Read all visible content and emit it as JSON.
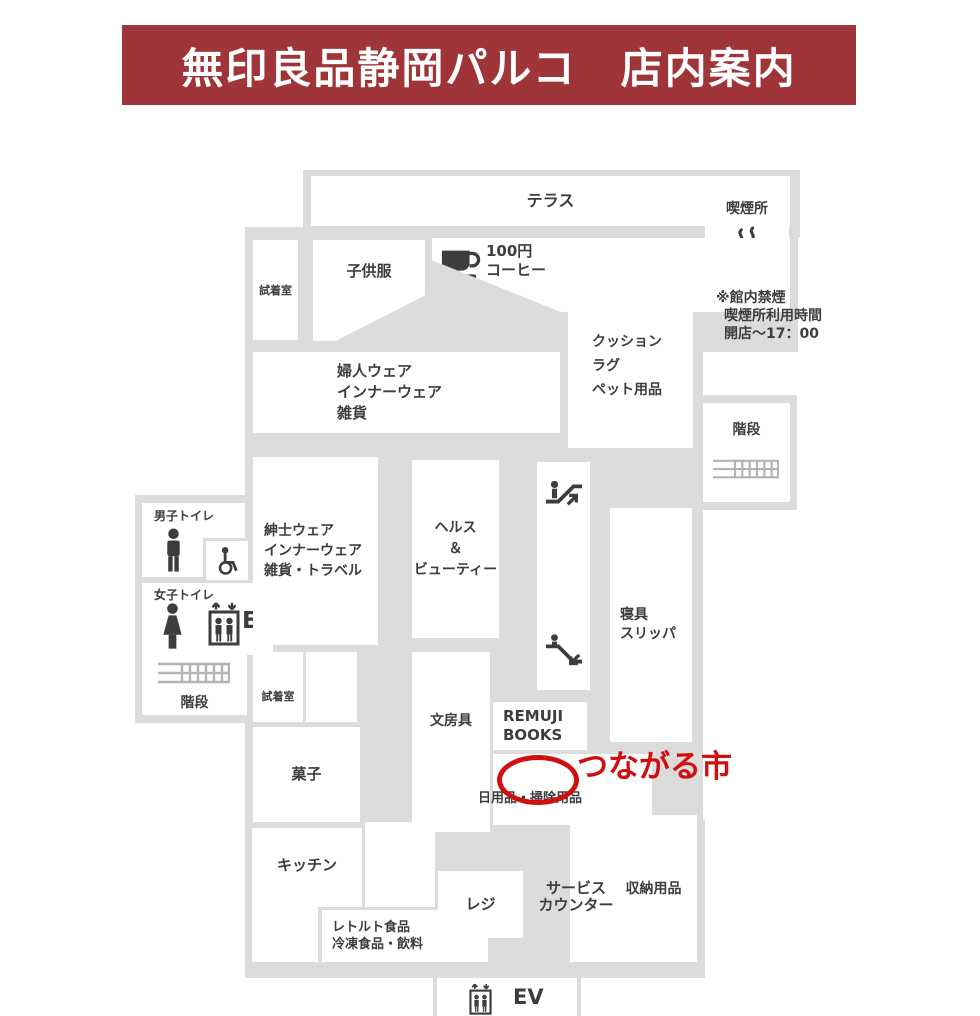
{
  "page": {
    "width": 980,
    "height": 1016,
    "bg": "#ffffff"
  },
  "palette": {
    "header_bg": "#9f3538",
    "header_fg": "#ffffff",
    "floor": "#dcdcdc",
    "room": "#ffffff",
    "ink": "#3d3d3d",
    "stairs_line": "#b3b3b3",
    "red": "#d01010"
  },
  "header": {
    "title": "無印良品静岡パルコ　店内案内"
  },
  "map": {
    "slabs": [
      {
        "x": 303,
        "y": 170,
        "w": 497,
        "h": 67
      },
      {
        "x": 697,
        "y": 172,
        "w": 100,
        "h": 116
      },
      {
        "x": 245,
        "y": 227,
        "w": 320,
        "h": 215
      },
      {
        "x": 425,
        "y": 235,
        "w": 373,
        "h": 117
      },
      {
        "x": 560,
        "y": 312,
        "w": 143,
        "h": 200
      },
      {
        "x": 695,
        "y": 395,
        "w": 102,
        "h": 115
      },
      {
        "x": 245,
        "y": 433,
        "w": 350,
        "h": 300
      },
      {
        "x": 135,
        "y": 495,
        "w": 112,
        "h": 228
      },
      {
        "x": 245,
        "y": 727,
        "w": 126,
        "h": 240
      },
      {
        "x": 360,
        "y": 727,
        "w": 60,
        "h": 100
      },
      {
        "x": 408,
        "y": 645,
        "w": 245,
        "h": 185
      },
      {
        "x": 593,
        "y": 505,
        "w": 110,
        "h": 240
      },
      {
        "x": 593,
        "y": 742,
        "w": 110,
        "h": 100
      },
      {
        "x": 245,
        "y": 820,
        "w": 460,
        "h": 158
      },
      {
        "x": 433,
        "y": 972,
        "w": 148,
        "h": 44
      }
    ],
    "rooms": [
      {
        "id": "terrace",
        "x": 311,
        "y": 176,
        "w": 479,
        "h": 50,
        "label": {
          "lines": [
            "テラス"
          ],
          "size": 16,
          "align": "center",
          "valign": "center"
        }
      },
      {
        "id": "smoking-area",
        "x": 705,
        "y": 180,
        "w": 84,
        "h": 100,
        "label": {
          "lines": [
            "喫煙所"
          ],
          "size": 14,
          "align": "center",
          "valign": "top",
          "padTop": 20
        },
        "icons": [
          {
            "type": "cigarette",
            "x": 24,
            "y": 46,
            "w": 38,
            "h": 40
          }
        ]
      },
      {
        "id": "fitting-room-upper",
        "x": 253,
        "y": 240,
        "w": 45,
        "h": 100,
        "label": {
          "lines": [
            "試着室"
          ],
          "size": 11,
          "align": "center",
          "valign": "center"
        }
      },
      {
        "id": "kids-wear",
        "x": 313,
        "y": 240,
        "w": 112,
        "h": 101,
        "clip": "polygon(0 0,100% 0,100% 55%,20% 100%,0 100%)",
        "label": {
          "lines": [
            "子供服"
          ],
          "size": 15,
          "align": "center",
          "valign": "top",
          "padTop": 22
        }
      },
      {
        "id": "coffee-corner",
        "x": 432,
        "y": 238,
        "w": 358,
        "h": 74,
        "clip": "polygon(0 0,100% 0,100% 100%,36% 100%,0 30%)",
        "label": {
          "lines": [
            "100円",
            "コーヒー"
          ],
          "size": 15,
          "lh": 19,
          "align": "left",
          "valign": "top",
          "padTop": 4,
          "padLeft": 54
        },
        "icons": [
          {
            "type": "coffee",
            "x": 7,
            "y": 5,
            "w": 42,
            "h": 40
          }
        ]
      },
      {
        "id": "womens-wear",
        "x": 253,
        "y": 352,
        "w": 307,
        "h": 81,
        "label": {
          "lines": [
            "婦人ウェア",
            "インナーウェア",
            "雑貨"
          ],
          "size": 15,
          "lh": 21,
          "align": "left",
          "valign": "center",
          "padLeft": 84
        }
      },
      {
        "id": "cushion-rug-pet",
        "x": 568,
        "y": 283,
        "w": 125,
        "h": 165,
        "label": {
          "lines": [
            "クッション",
            "ラグ",
            "ペット用品"
          ],
          "size": 14,
          "lh": 24,
          "align": "left",
          "valign": "center",
          "padLeft": 24
        }
      },
      {
        "id": "stairs-upper",
        "x": 703,
        "y": 403,
        "w": 87,
        "h": 99,
        "label": {
          "lines": [
            "階段"
          ],
          "size": 14,
          "align": "center",
          "valign": "top",
          "padTop": 18
        },
        "icons": [
          {
            "type": "stairs",
            "x": 10,
            "y": 52,
            "w": 66,
            "h": 30
          }
        ]
      },
      {
        "id": "mens-toilet",
        "x": 142,
        "y": 503,
        "w": 103,
        "h": 74,
        "label": {
          "lines": [
            "男子トイレ"
          ],
          "size": 12,
          "align": "left",
          "valign": "top",
          "padTop": 5,
          "padLeft": 12
        },
        "icons": [
          {
            "type": "man",
            "x": 20,
            "y": 25,
            "w": 23,
            "h": 45
          }
        ],
        "sub": {
          "x": 61,
          "y": 35,
          "w": 42,
          "h": 39,
          "icon": "wheelchair"
        }
      },
      {
        "id": "womens-toilet",
        "x": 142,
        "y": 583,
        "w": 131,
        "h": 72,
        "label": {
          "lines": [
            "女子トイレ"
          ],
          "size": 12,
          "align": "left",
          "valign": "top",
          "padTop": 4,
          "padLeft": 12
        },
        "icons": [
          {
            "type": "woman",
            "x": 17,
            "y": 20,
            "w": 27,
            "h": 47
          },
          {
            "type": "elevator",
            "x": 65,
            "y": 16,
            "w": 34,
            "h": 48
          }
        ],
        "badges": [
          {
            "text": "EV",
            "x": 100,
            "y": 27,
            "size": 23
          }
        ]
      },
      {
        "id": "stairs-lower-left",
        "x": 142,
        "y": 653,
        "w": 105,
        "h": 62,
        "label": {
          "lines": [
            "階段"
          ],
          "size": 14,
          "align": "center",
          "valign": "bottom",
          "padBottom": 3
        },
        "icons": [
          {
            "type": "stairs",
            "x": 16,
            "y": 7,
            "w": 72,
            "h": 28
          }
        ]
      },
      {
        "id": "mens-wear",
        "x": 253,
        "y": 457,
        "w": 125,
        "h": 188,
        "label": {
          "lines": [
            "紳士ウェア",
            "インナーウェア",
            "雑貨・トラベル"
          ],
          "size": 14,
          "lh": 20,
          "align": "left",
          "valign": "center",
          "padLeft": 11
        }
      },
      {
        "id": "health-beauty",
        "x": 412,
        "y": 460,
        "w": 87,
        "h": 178,
        "label": {
          "lines": [
            "ヘルス",
            "＆",
            "ビューティー"
          ],
          "size": 14,
          "lh": 21,
          "align": "center",
          "valign": "center"
        }
      },
      {
        "id": "escalators",
        "x": 537,
        "y": 462,
        "w": 53,
        "h": 228,
        "icons": [
          {
            "type": "escalator-up",
            "x": 6,
            "y": 12,
            "w": 42,
            "h": 38
          },
          {
            "type": "escalator-down",
            "x": 6,
            "y": 172,
            "w": 42,
            "h": 38
          }
        ]
      },
      {
        "id": "bedding-slippers",
        "x": 610,
        "y": 508,
        "w": 82,
        "h": 234,
        "label": {
          "lines": [
            "寝具",
            "スリッパ"
          ],
          "size": 14,
          "lh": 19,
          "align": "left",
          "valign": "center",
          "padLeft": 10
        }
      },
      {
        "id": "fitting-room-lower",
        "x": 253,
        "y": 652,
        "w": 50,
        "h": 70,
        "label": {
          "lines": [
            "試着室"
          ],
          "size": 11,
          "align": "center",
          "valign": "bottom",
          "padBottom": 18
        }
      },
      {
        "id": "open-area",
        "x": 306,
        "y": 652,
        "w": 51,
        "h": 70
      },
      {
        "id": "stationery",
        "x": 412,
        "y": 652,
        "w": 78,
        "h": 180,
        "label": {
          "lines": [
            "文房具"
          ],
          "size": 14,
          "align": "center",
          "valign": "top",
          "padTop": 60
        }
      },
      {
        "id": "remuji-books",
        "x": 493,
        "y": 702,
        "w": 94,
        "h": 48,
        "label": {
          "lines": [
            "REMUJI",
            "BOOKS"
          ],
          "size": 15,
          "lh": 19,
          "align": "left",
          "valign": "center",
          "padLeft": 10
        }
      },
      {
        "id": "daily-cleaning-goods",
        "x": 493,
        "y": 754,
        "w": 159,
        "h": 71
      },
      {
        "id": "sweets",
        "x": 253,
        "y": 727,
        "w": 107,
        "h": 95,
        "label": {
          "lines": [
            "菓子"
          ],
          "size": 15,
          "align": "center",
          "valign": "center"
        }
      },
      {
        "id": "kitchen",
        "x": 252,
        "y": 828,
        "w": 110,
        "h": 134,
        "clip": "polygon(0 0,100% 0,100% 59%,60% 59%,60% 100%,0 100%)",
        "label": {
          "lines": [
            "キッチン"
          ],
          "size": 15,
          "align": "center",
          "valign": "top",
          "padTop": 28
        }
      },
      {
        "id": "retort-frozen-foods",
        "x": 322,
        "y": 910,
        "w": 166,
        "h": 52,
        "label": {
          "lines": [
            "レトルト食品",
            "冷凍食品・飲料"
          ],
          "size": 13,
          "lh": 17,
          "align": "left",
          "valign": "center",
          "padLeft": 10
        }
      },
      {
        "id": "open-area-2",
        "x": 365,
        "y": 822,
        "w": 70,
        "h": 85
      },
      {
        "id": "register",
        "x": 438,
        "y": 871,
        "w": 85,
        "h": 67,
        "label": {
          "lines": [
            "レジ"
          ],
          "size": 15,
          "align": "center",
          "valign": "center"
        }
      },
      {
        "id": "storage-goods",
        "x": 570,
        "y": 815,
        "w": 127,
        "h": 147,
        "label": {
          "lines": [
            "収納用品"
          ],
          "size": 14,
          "align": "center",
          "valign": "center",
          "padLeft": 40
        }
      },
      {
        "id": "elevator-lower",
        "x": 437,
        "y": 978,
        "w": 140,
        "h": 38,
        "icons": [
          {
            "type": "elevator",
            "x": 30,
            "y": 4,
            "w": 27,
            "h": 33
          }
        ],
        "badges": [
          {
            "text": "EV",
            "x": 76,
            "y": 9,
            "size": 21
          }
        ]
      }
    ],
    "floating_labels": [
      {
        "id": "no-smoking-note",
        "x": 716,
        "y": 289,
        "size": 14,
        "lh": 18,
        "color": "ink",
        "lines": [
          "※館内禁煙",
          "喫煙所利用時間",
          "開店～17：00"
        ],
        "indents": [
          0,
          8,
          8
        ]
      },
      {
        "id": "service-counter",
        "x": 521,
        "y": 880,
        "w": 110,
        "size": 15,
        "lh": 17,
        "color": "ink",
        "align": "center",
        "lines": [
          "サービス",
          "カウンター"
        ]
      },
      {
        "id": "tsunagaru-market",
        "x": 577,
        "y": 748,
        "size": 31,
        "lh": 38,
        "color": "red",
        "lines": [
          "つながる市"
        ]
      },
      {
        "id": "daily-goods-label",
        "x": 478,
        "y": 791,
        "size": 13,
        "lh": 15,
        "color": "ink",
        "lines": [
          "日用品・掃除用品"
        ]
      }
    ],
    "marker": {
      "id": "tsunagaru-market-marker",
      "x": 497,
      "y": 755,
      "w": 72,
      "h": 40,
      "stroke": 5
    }
  }
}
